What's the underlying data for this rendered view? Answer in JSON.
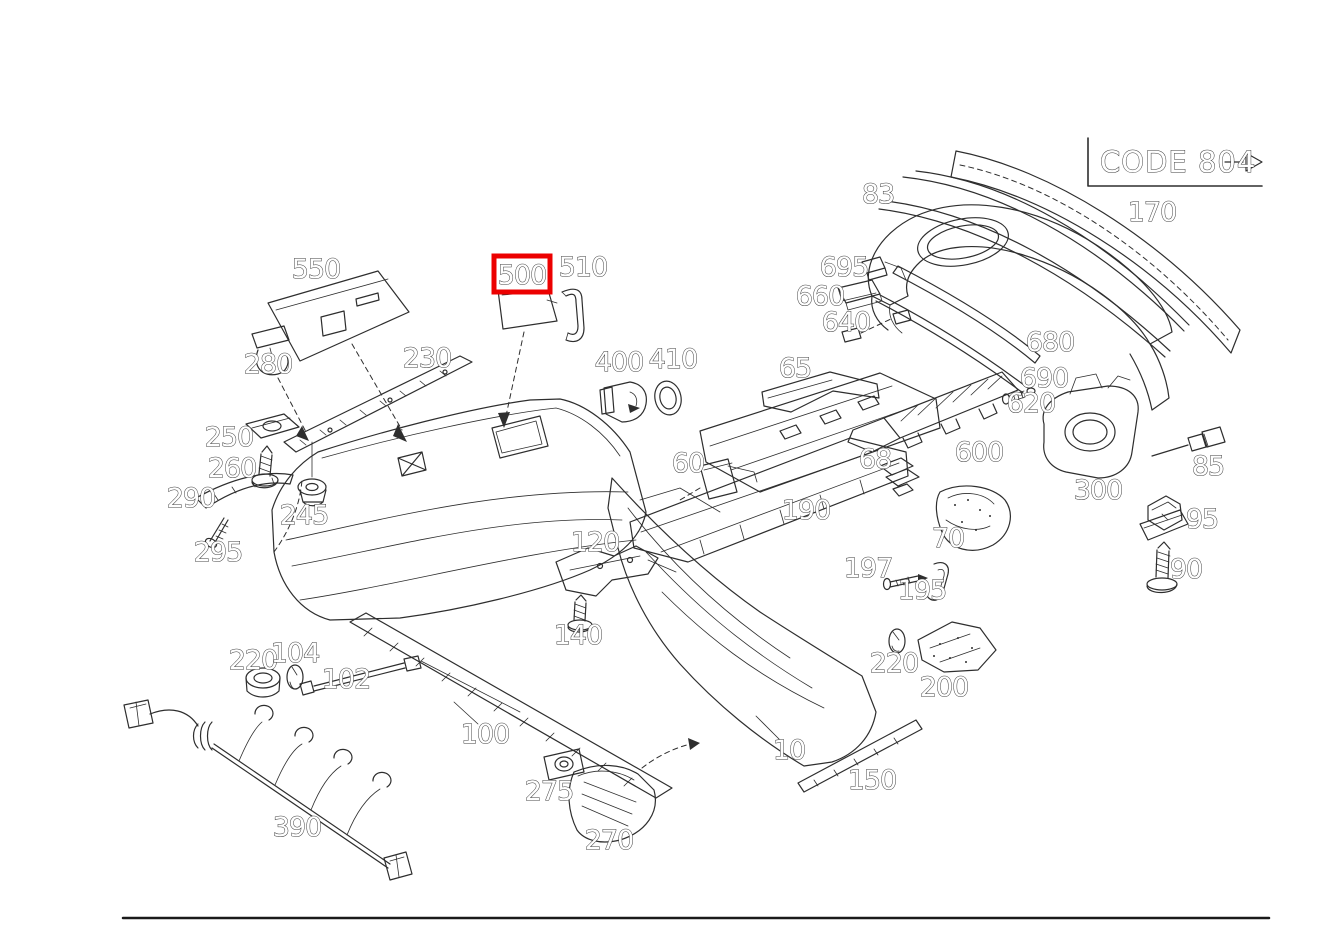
{
  "diagram": {
    "title_code": "CODE 804",
    "highlighted_part": "500",
    "highlight_color": "#ec0000",
    "line_color": "#2e2e2e",
    "background_color": "#ffffff",
    "labels": {
      "p550": "550",
      "p500": "500",
      "p510": "510",
      "p280": "280",
      "p230": "230",
      "p250": "250",
      "p260": "260",
      "p290": "290",
      "p295": "295",
      "p245": "245",
      "p400": "400",
      "p410": "410",
      "p65": "65",
      "p83": "83",
      "p695": "695",
      "p660": "660",
      "p640": "640",
      "p680": "680",
      "p690": "690",
      "p620": "620",
      "p600": "600",
      "p300": "300",
      "p170": "170",
      "p85": "85",
      "p95": "95",
      "p90": "90",
      "p60": "60",
      "p68": "68",
      "p190": "190",
      "p120": "120",
      "p140": "140",
      "p197": "197",
      "p195": "195",
      "p70": "70",
      "p220_left": "220",
      "p104": "104",
      "p102": "102",
      "p100": "100",
      "p10": "10",
      "p150": "150",
      "p275": "275",
      "p270": "270",
      "p390": "390",
      "p220_right": "220",
      "p200": "200"
    }
  }
}
